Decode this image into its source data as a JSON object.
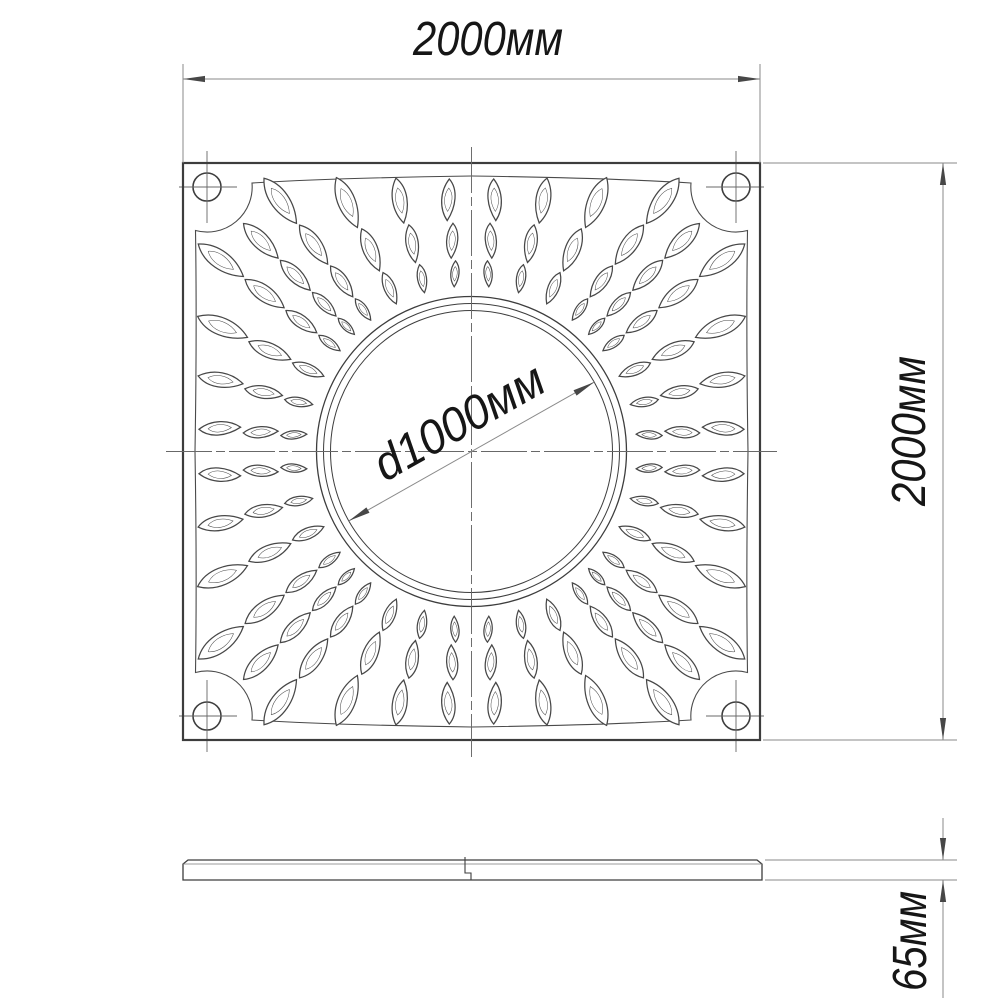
{
  "drawing": {
    "title": "tree-grate-technical-drawing",
    "plan": {
      "width_dim": "2000мм",
      "height_dim": "2000мм",
      "diameter_dim": "d1000мм"
    },
    "section": {
      "thickness_dim": "65мм"
    },
    "colors": {
      "background": "#ffffff",
      "outline": "#3d3d3d",
      "pattern_line": "#474747",
      "frame_line": "#4a4a4a",
      "centerline": "#686868",
      "dimension_line": "#8a8a8a",
      "arrow": "#474747",
      "text": "#161616"
    }
  }
}
